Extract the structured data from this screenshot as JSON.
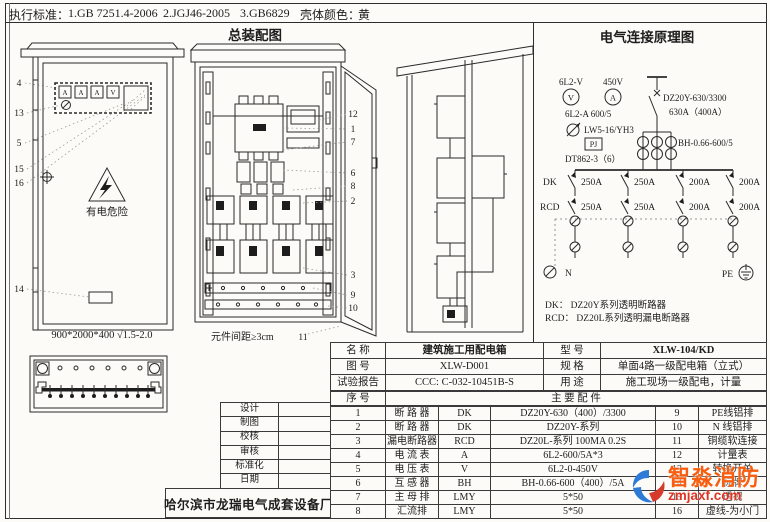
{
  "header": {
    "standards_label": "执行标准：",
    "standard_1": "1.GB 7251.4-2006",
    "standard_2": "2.JGJ46-2005",
    "standard_3": "3.GB6829",
    "shell_color_label": "壳体颜色：",
    "shell_color_value": "黄"
  },
  "assembly": {
    "title": "总装配图",
    "spacing_note": "元件间距≥3cm",
    "door_callout": "11",
    "callouts": [
      "12",
      "1",
      "7",
      "6",
      "8",
      "2",
      "3",
      "9",
      "10"
    ]
  },
  "front_view": {
    "callouts": [
      "4",
      "13",
      "5",
      "15",
      "16",
      "14"
    ],
    "meters": [
      "A",
      "A",
      "A",
      "V"
    ],
    "danger_text": "有电危险",
    "dimensions": "900*2000*400 √1.5-2.0"
  },
  "schematic": {
    "title": "电气连接原理图",
    "voltmeter_label": "6L2-V",
    "voltmeter_symbol": "V",
    "ammeter_range": "450V",
    "ammeter_symbol": "A",
    "ammeter_model": "6L2-A 600/5",
    "switch_model": "LW5-16/YH3",
    "pj_label": "PJ",
    "energy_meter_model": "DT862-3（6）",
    "main_breaker_model": "DZ20Y-630/3300",
    "main_breaker_rating": "630A（400A）",
    "ct_model": "BH-0.66-600/5",
    "dk_label": "DK",
    "rcd_label": "RCD",
    "dk_ratings": [
      "250A",
      "250A",
      "200A",
      "200A"
    ],
    "rcd_ratings": [
      "250A",
      "250A",
      "200A",
      "200A"
    ],
    "n_label": "N",
    "pe_label": "PE",
    "legend_dk": "DK：  DZ20Y系列透明断路器",
    "legend_rcd": "RCD： DZ20L系列透明漏电断路器"
  },
  "title_block": {
    "rows": [
      "设计",
      "制图",
      "校核",
      "审核",
      "标准化",
      "日期"
    ],
    "manufacturer": "哈尔滨市龙瑞电气成套设备厂"
  },
  "spec_table": {
    "name_label": "名    称",
    "name_value": "建筑施工用配电箱",
    "model_label": "型    号",
    "model_value": "XLW-104/KD",
    "figure_label": "图    号",
    "figure_value": "XLW-D001",
    "spec_label": "规    格",
    "spec_value": "单面4路一级配电箱（立式）",
    "report_label": "试验报告",
    "report_value": "CCC: C-032-10451B-S",
    "usage_label": "用    途",
    "usage_value": "施工现场一级配电，计量",
    "seq_label": "序    号",
    "parts_header": "主  要  配  件",
    "parts": [
      {
        "no": "1",
        "name": "断 路 器",
        "code": "DK",
        "spec": "DZ20Y-630（400）/3300",
        "no2": "9",
        "name2": "PE线铝排"
      },
      {
        "no": "2",
        "name": "断 路 器",
        "code": "DK",
        "spec": "DZ20Y-系列",
        "no2": "10",
        "name2": "N 线铝排"
      },
      {
        "no": "3",
        "name": "漏电断路器",
        "code": "RCD",
        "spec": "DZ20L-系列  100MA 0.2S",
        "no2": "11",
        "name2": "铜缆软连接"
      },
      {
        "no": "4",
        "name": "电 流 表",
        "code": "A",
        "spec": "6L2-600/5A*3",
        "no2": "12",
        "name2": "计量表"
      },
      {
        "no": "5",
        "name": "电 压 表",
        "code": "V",
        "spec": "6L2-0-450V",
        "no2": "13",
        "name2": "转换开关"
      },
      {
        "no": "6",
        "name": "互 感 器",
        "code": "BH",
        "spec": "BH-0.66-600（400）/5A",
        "no2": "14",
        "name2": "标牌"
      },
      {
        "no": "7",
        "name": "主 母 排",
        "code": "LMY",
        "spec": "5*50",
        "no2": "15",
        "name2": "透视"
      },
      {
        "no": "8",
        "name": "汇流排",
        "code": "LMY",
        "spec": "5*50",
        "no2": "16",
        "name2": "虚线-为小门"
      }
    ]
  },
  "watermark": {
    "brand": "智淼消防",
    "site": "zmjaxf.com"
  }
}
